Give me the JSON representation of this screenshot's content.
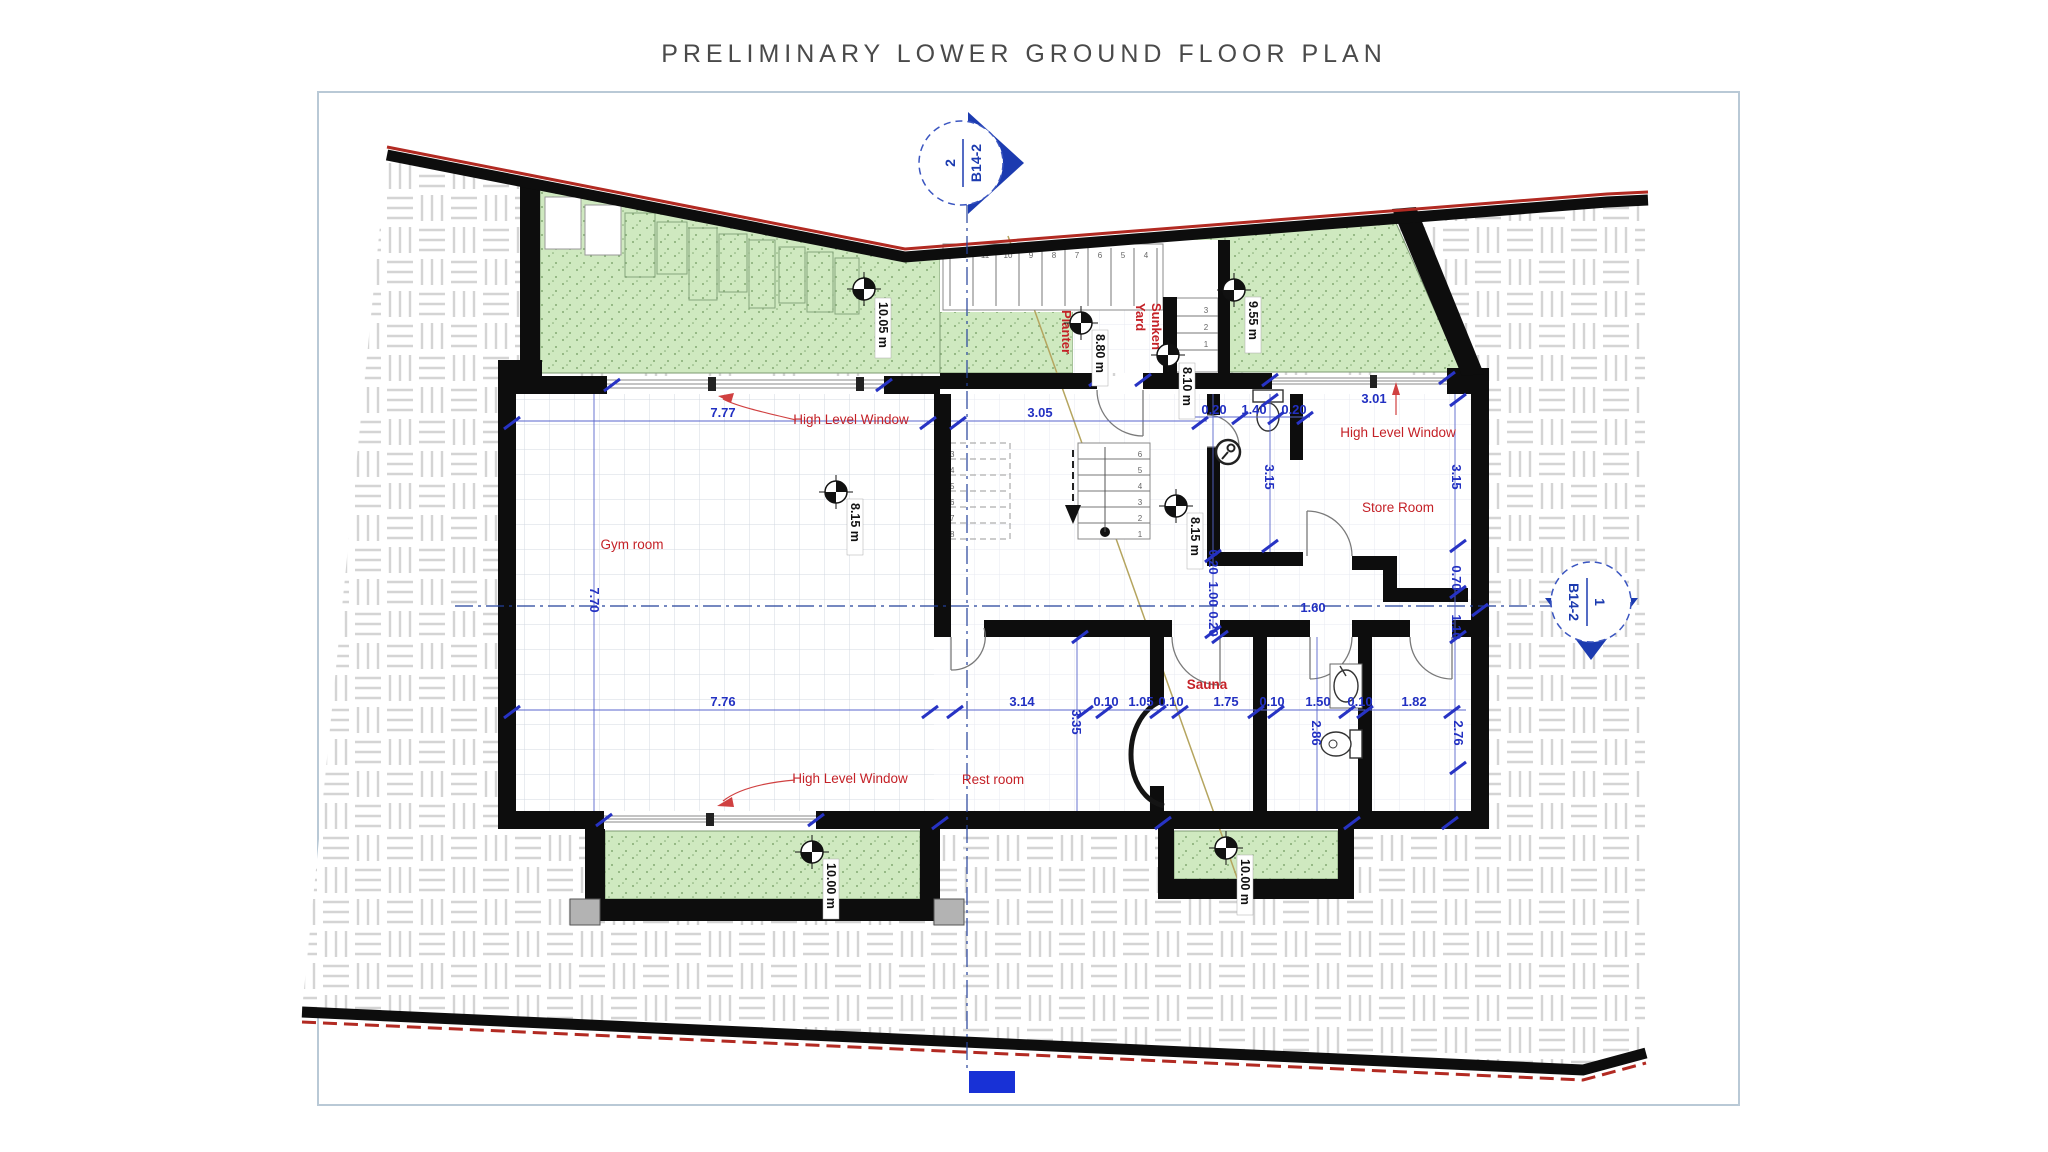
{
  "title": "PRELIMINARY LOWER GROUND FLOOR PLAN",
  "section_markers": {
    "top": {
      "number": "2",
      "sheet": "B14-2"
    },
    "right": {
      "number": "1",
      "sheet": "B14-2"
    }
  },
  "rooms": {
    "gym": "Gym room",
    "rest": "Rest room",
    "sauna": "Sauna",
    "store": "Store Room"
  },
  "site": {
    "planter": "Planter",
    "sunken_yard_line1": "Sunken",
    "sunken_yard_line2": "Yard"
  },
  "windows": {
    "gym_top": "High Level Window",
    "store_top": "High Level Window",
    "gym_bottom": "High Level Window"
  },
  "levels": {
    "planter_top": "10.05 m",
    "yard_mid": "8.80 m",
    "yard_door": "8.10 m",
    "yard_right": "9.55 m",
    "gym": "8.15 m",
    "stair": "8.15 m",
    "planter_bl": "10.00 m",
    "planter_br": "10.00 m"
  },
  "dims": {
    "gym_top": "7.77",
    "gym_left": "7.70",
    "gym_bottom": "7.76",
    "stair_top": "3.05",
    "rest_w": "3.14",
    "rest_h": "3.35",
    "s1": "0.10",
    "s2": "1.05",
    "s3": "0.10",
    "s4": "1.75",
    "s5": "0.10",
    "s6": "1.50",
    "s7": "0.10",
    "s8": "1.82",
    "sauna_h": "2.86",
    "corr_h": "2.76",
    "wc1": "0.20",
    "wc2": "1.40",
    "wc3": "0.20",
    "wc_h": "3.15",
    "store_h": "3.15",
    "store_top": "3.01",
    "corr_w": "1.60",
    "notch": "0.70",
    "notch2": "1.10",
    "cl1": "0.20",
    "cl2": "1.00",
    "cl3": "0.20"
  },
  "stairs": {
    "inner_numbers": [
      "6",
      "5",
      "4",
      "3",
      "2",
      "1"
    ],
    "upper_numbers": [
      "13",
      "14",
      "15",
      "16",
      "17",
      "18"
    ],
    "entry_numbers": [
      "3",
      "2",
      "1"
    ],
    "yard_numbers": [
      "12",
      "11",
      "10",
      "9",
      "8",
      "7",
      "6",
      "5",
      "4"
    ]
  },
  "colors": {
    "dimension_blue": "#2230c2",
    "label_red": "#c42127",
    "marker_blue": "#1c3bb0",
    "planter_green": "#cfe9c0",
    "boundary_red": "#b22a22"
  }
}
